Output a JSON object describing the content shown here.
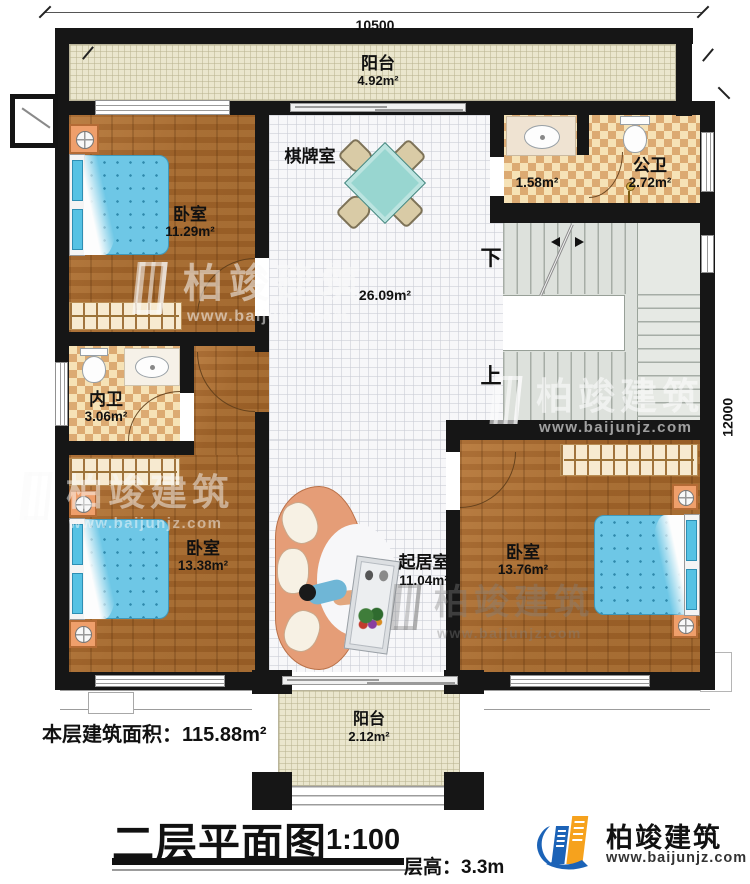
{
  "dimensions": {
    "top": "10500",
    "right": "12000"
  },
  "rooms": {
    "balcony_top": {
      "name": "阳台",
      "area": "4.92m²"
    },
    "chess_room": {
      "name": "棋牌室"
    },
    "bedroom_top_left": {
      "name": "卧室",
      "area": "11.29m²"
    },
    "washroom": {
      "area": "1.58m²"
    },
    "public_bathroom": {
      "name": "公卫",
      "area": "2.72m²"
    },
    "hall": {
      "area": "26.09m²"
    },
    "private_bathroom": {
      "name": "内卫",
      "area": "3.06m²"
    },
    "bedroom_bottom_left": {
      "name": "卧室",
      "area": "13.38m²"
    },
    "living_room": {
      "name": "起居室",
      "area": "11.04m²"
    },
    "bedroom_bottom_right": {
      "name": "卧室",
      "area": "13.76m²"
    },
    "balcony_bottom": {
      "name": "阳台",
      "area": "2.12m²"
    }
  },
  "stairs": {
    "down": "下",
    "up": "上"
  },
  "watermark": {
    "name": "柏竣建筑",
    "url": "www.baijunjz.com"
  },
  "logo": {
    "name": "柏竣建筑",
    "url": "www.baijunjz.com"
  },
  "footer": {
    "floor_area_label": "本层建筑面积：",
    "floor_area_value": "115.88m²",
    "title": "二层平面图",
    "scale": "1:100",
    "floor_height_label": "层高：",
    "floor_height_value": "3.3m"
  },
  "colors": {
    "wall": "#161616",
    "wood_floor": "#a8692e",
    "tile_floor": "#f7f7f9",
    "checker_dark": "#dcaa72",
    "checker_light": "#f6e2b6",
    "balcony": "#eae6cd",
    "stair": "#dde1dc",
    "bed_blue": "#6ec7e6",
    "table_teal": "#98d6d0",
    "sofa_peach": "#e59d77",
    "logo_blue": "#1c63b7",
    "logo_orange": "#f6a21d"
  }
}
